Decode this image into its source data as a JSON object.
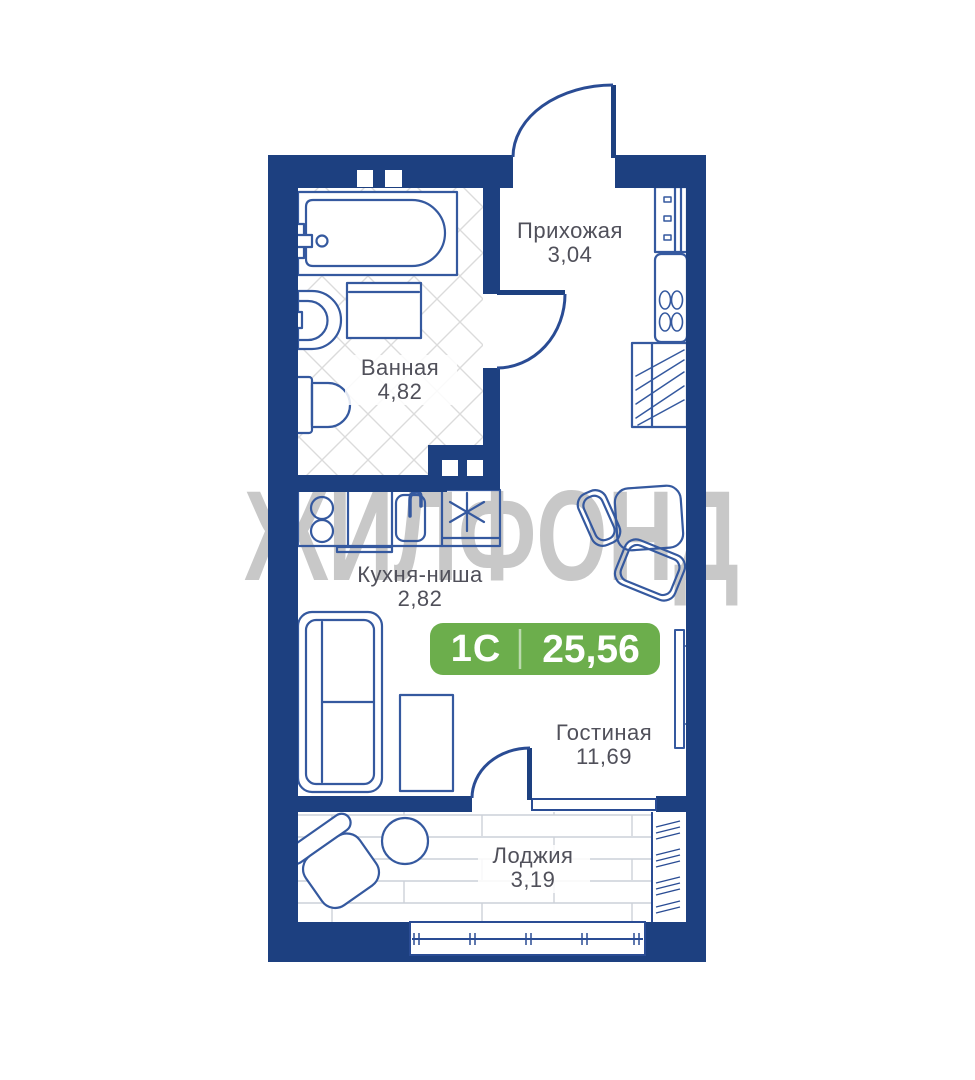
{
  "watermark": "ЖИЛФОНД",
  "badge": {
    "type_label": "1С",
    "area_total": "25,56",
    "color": "#6cae4c"
  },
  "rooms": {
    "hallway": {
      "name": "Прихожая",
      "area": "3,04"
    },
    "bathroom": {
      "name": "Ванная",
      "area": "4,82"
    },
    "kitchen": {
      "name": "Кухня-ниша",
      "area": "2,82"
    },
    "living": {
      "name": "Гостиная",
      "area": "11,69"
    },
    "loggia": {
      "name": "Лоджия",
      "area": "3,19"
    }
  },
  "colors": {
    "wall": "#1d4080",
    "line": "#35599f",
    "door": "#2a4c94",
    "label": "#50505a",
    "watermark": "#c8c8c8",
    "badge_green": "#6cae4c",
    "tile": "#dbdbdb",
    "plank": "#ccd1d8"
  }
}
